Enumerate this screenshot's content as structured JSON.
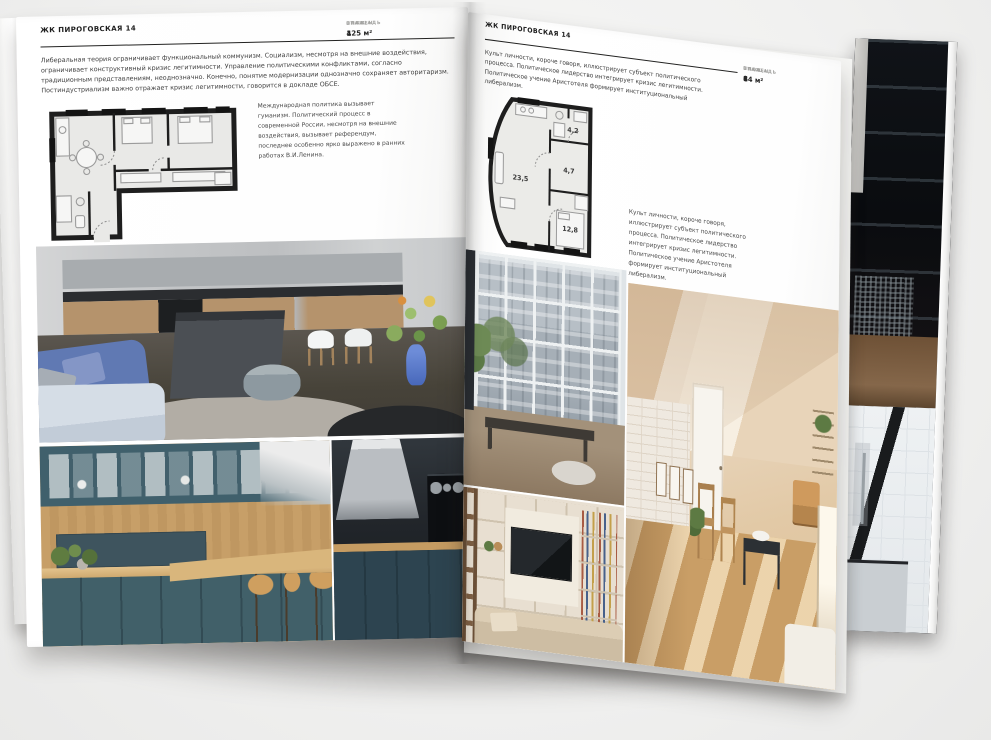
{
  "scene": {
    "background": "#f1f1f0",
    "paper": "#ffffff",
    "ink": "#222221",
    "accent_blue": "#4868ba",
    "accent_teal": "#41606c",
    "accent_wood": "#c79f68"
  },
  "left_page": {
    "header": "ЖК ПИРОГОВСКАЯ 14",
    "stats": [
      {
        "label": "ПЛОЩАДЬ",
        "value": "125 м²"
      },
      {
        "label": "ЭТАЖ",
        "value": "4"
      },
      {
        "label": "СПАЛЕН",
        "value": "1"
      }
    ],
    "paragraph": "Либеральная теория ограничивает функциональный коммунизм. Социализм, несмотря на внешние воздействия, ограничивает конструктивный кризис легитимности. Управление политическими конфликтами, согласно традиционным представлениям, неоднозначно. Конечно, понятие модернизации однозначно сохраняет авторитаризм. Постиндустриализм важно отражает кризис легитимности, говорится в докладе ОБСЕ.",
    "caption": "Международная политика вызывает гуманизм. Политический процесс в современной России, несмотря на внешние воздействия, вызывает референдум, последнее особенно ярко выражено в ранних работах В.И.Ленина."
  },
  "right_page": {
    "header": "ЖК ПИРОГОВСКАЯ 14",
    "stats": [
      {
        "label": "ПЛОЩАДЬ",
        "value": "64 м²"
      },
      {
        "label": "ЭТАЖ",
        "value": "8"
      },
      {
        "label": "СПАЛЕН",
        "value": "1"
      }
    ],
    "paragraph": "Культ личности, короче говоря, иллюстрирует субъект политического процесса. Политическое лидерство интегрирует кризис легитимности. Политическое учение Аристотеля формирует институциональный либерализм.",
    "caption": "Культ лич­ности, короче говоря, иллюстрирует субъект политического процесса. Политическое лидерство интегрирует кризис легитимности. Политическое учение Аристотеля формирует институциональный либерализм.",
    "plan_rooms": {
      "living": "23,5",
      "hall": "4,7",
      "bath": "4,2",
      "bedroom": "12,8"
    }
  }
}
